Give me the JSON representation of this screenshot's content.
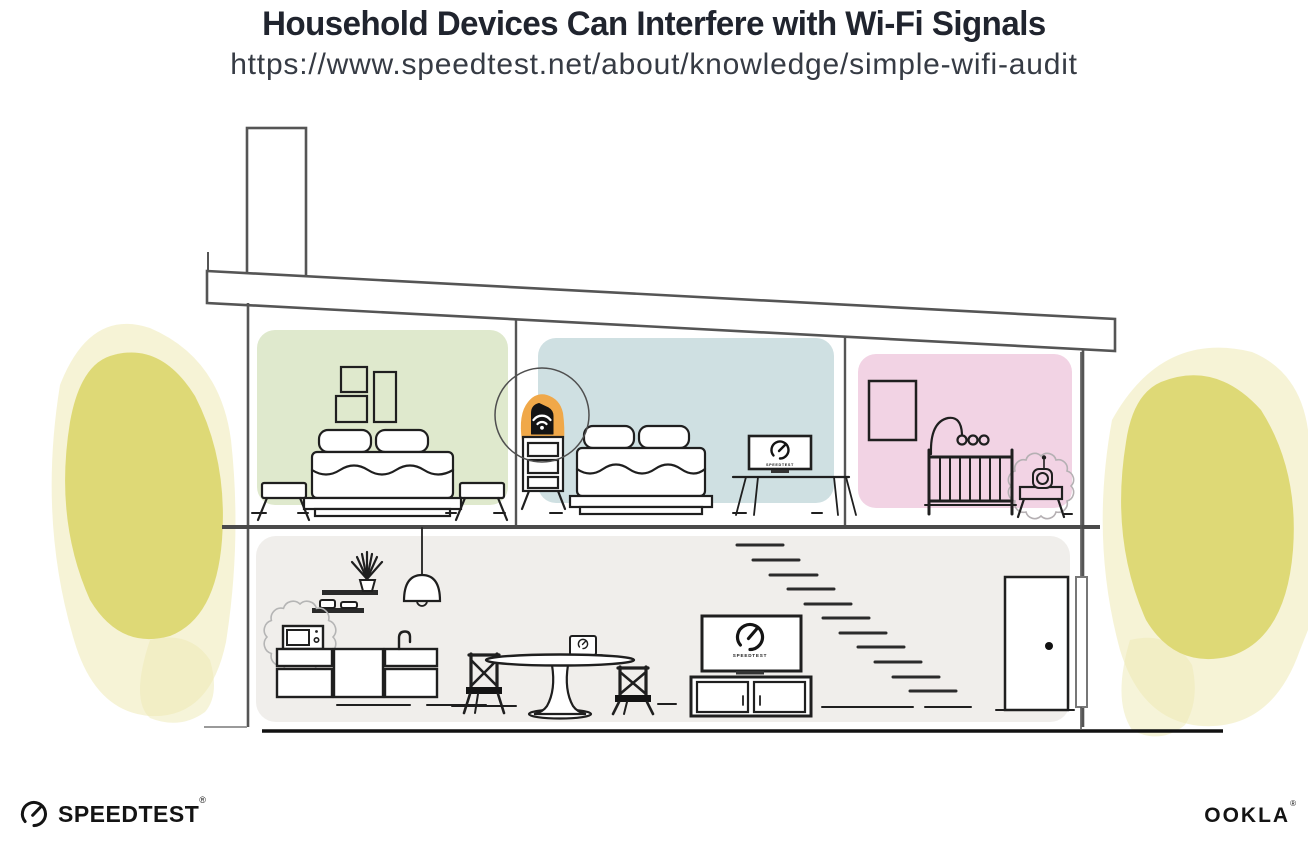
{
  "header": {
    "title": "Household Devices Can Interfere with Wi-Fi Signals",
    "url": "https://www.speedtest.net/about/knowledge/simple-wifi-audit"
  },
  "footer": {
    "speedtest_wordmark": "SPEEDTEST",
    "speedtest_trademark": "®",
    "ookla_wordmark": "OOKLA",
    "ookla_trademark": "®"
  },
  "illustration": {
    "type": "house-cross-section",
    "screen_label": "SPEEDTEST",
    "colors": {
      "bedroom_left_wall": "#dfe9cd",
      "bedroom_middle_wall": "#cfe0e2",
      "nursery_wall": "#f2d3e4",
      "downstairs_wall": "#f0eeeb",
      "router_highlight": "#f0a849",
      "foliage_core": "#dcd66b",
      "foliage_wash": "#eee9b4",
      "structure_outline": "#555555",
      "furniture_ink": "#1f1f1f"
    },
    "depicted_objects": [
      "chimney",
      "roof",
      "wifi-router",
      "router-dresser",
      "bed",
      "picture-frames",
      "nightstand-stools",
      "laptop-monitor-desk",
      "crib",
      "baby-mobile",
      "baby-monitor",
      "pendant-lamp",
      "wall-shelves",
      "plant",
      "microwave",
      "kitchen-cabinets",
      "sink-faucet",
      "dining-table",
      "laptop",
      "dining-chairs",
      "television",
      "media-console",
      "staircase",
      "door",
      "downspout",
      "foliage"
    ],
    "interference_sources": [
      "microwave",
      "baby-monitor"
    ]
  }
}
